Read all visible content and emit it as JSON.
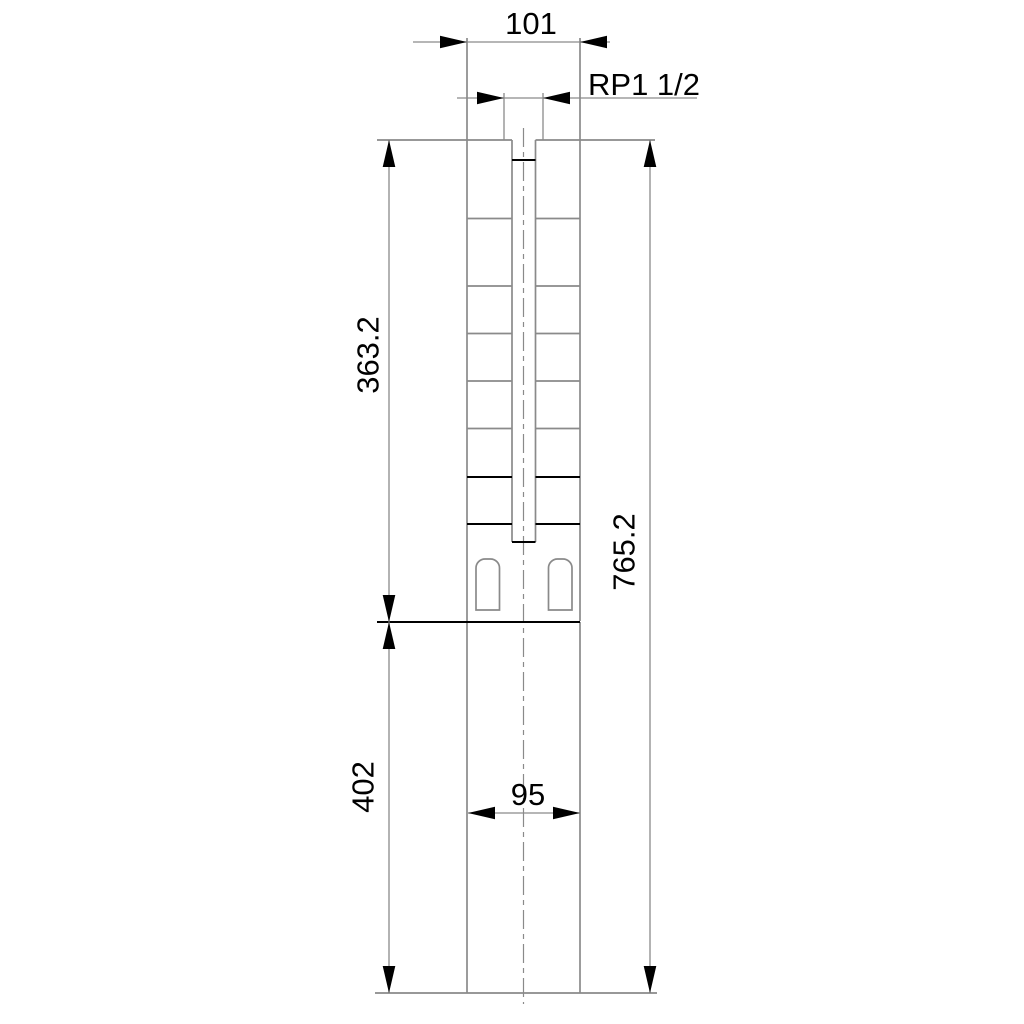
{
  "drawing": {
    "kind": "submersible-pump-dimensional-drawing",
    "labels": {
      "top_width": "101",
      "thread_connection": "RP1 1/2",
      "pump_section_length": "363.2",
      "total_length": "765.2",
      "motor_section_length": "402",
      "motor_width": "95"
    },
    "colors": {
      "background": "#ffffff",
      "outline": "#8a8a8a",
      "accent": "#000000",
      "text": "#000000"
    }
  }
}
